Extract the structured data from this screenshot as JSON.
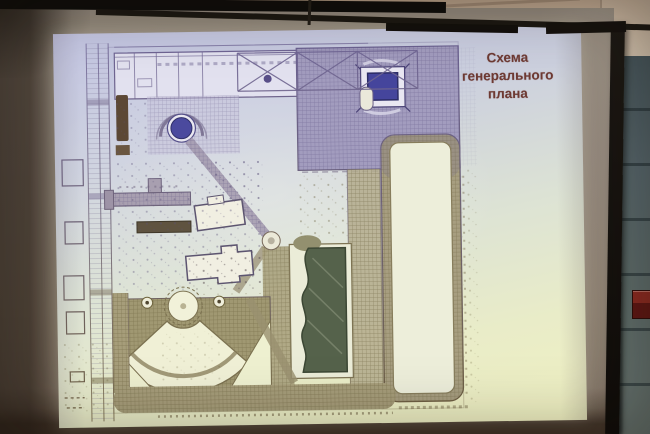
{
  "scene": {
    "type": "photograph of a projection screen showing a presentation slide",
    "room": {
      "ceiling_color": "#c3ae99",
      "wall_tile_color": "#5d6b69",
      "wall_grout_color": "#39464a",
      "screen_fabric_color": "#8a7d70",
      "screen_frame_color": "#16120e",
      "alarm_box_color": "#71201a"
    }
  },
  "slide": {
    "title": {
      "text": "Схема генерального плана",
      "lines": [
        "Схема",
        "генерального",
        "плана"
      ],
      "color": "#6e3a33"
    },
    "background_top_color": "#c5c7e4",
    "background_bottom_color": "#f0f1c2"
  },
  "plan": {
    "ink_top_color": "#6f6596",
    "ink_bottom_color": "#6f6040",
    "water_color": "#55624b",
    "fountain_color": "#4b4a9e",
    "building_roof_color": "#45459c",
    "features": [
      "perimeter street",
      "truss gallery band",
      "paved plaza",
      "round fountain",
      "blue pavilion",
      "sports field",
      "landscape pond",
      "amphitheater fan",
      "pavilion buildings",
      "grid walkways"
    ]
  }
}
